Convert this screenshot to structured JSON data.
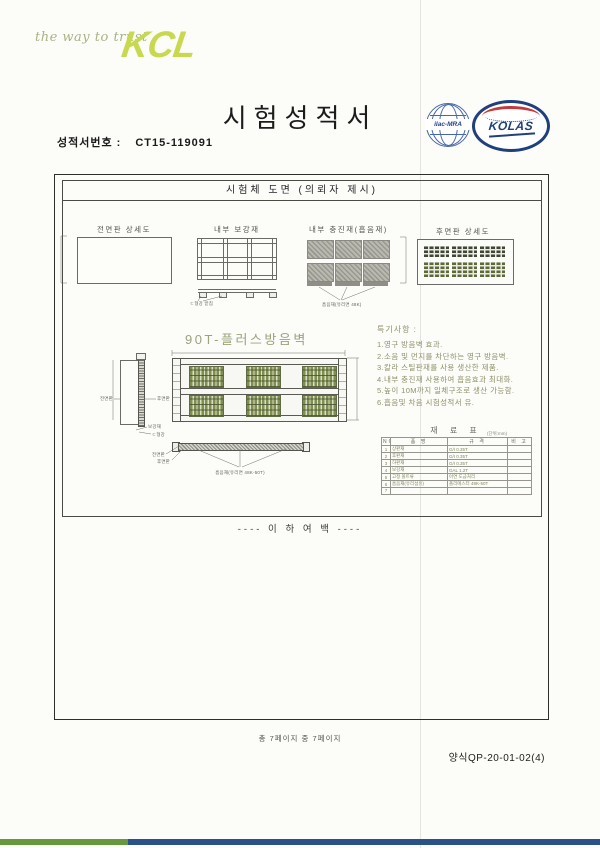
{
  "header": {
    "tagline": "the way to trust",
    "brand": "KCL",
    "title": "시험성적서",
    "report_no_label": "성적서번호 :",
    "report_no": "CT15-119091",
    "cert_ilac": "ilac-MRA",
    "cert_kolas": "KOLAS"
  },
  "drawing": {
    "box_title": "시험체 도면 (의뢰자 제시)",
    "view_labels": {
      "front": "전면판 상세도",
      "reinforce": "내부 보강재",
      "filler": "내부 충진재(흡음재)",
      "rear": "후면판 상세도"
    },
    "product_label": "90T-플러스방음벽",
    "callouts": {
      "reinforce_note": "ㄷ형강 받침",
      "filler_note": "흡음재(유리면 48K)",
      "side_front": "전면판",
      "side_rear": "후면판",
      "side_b1": "보강재",
      "side_b2": "ㄷ형강",
      "sec_l1": "전면판",
      "sec_l2": "후면판",
      "sec_note": "흡음재(유리면 48K-50T)"
    },
    "notes_title": "특기사항 :",
    "notes": [
      "1.영구 방음벽 효과.",
      "2.소음 및 먼지를 차단하는 영구 방음벽.",
      "3.칼라 스틸판재를 사용 생산한 제품.",
      "4.내부 충진재 사용하여 흡음효과 최대화.",
      "5.높이 10M까지 일체구조로 생산 가능함.",
      "6.흡음및 차음 시험성적서 유."
    ],
    "table": {
      "title": "재 료 표",
      "unit_note": "(단위:mm)",
      "headers": [
        "NO",
        "품 명",
        "규 격",
        "비 고"
      ],
      "rows": [
        [
          "1",
          "상판재",
          "G/I 0.35T",
          ""
        ],
        [
          "2",
          "후판재",
          "G/I 0.35T",
          ""
        ],
        [
          "3",
          "하판재",
          "G/I 0.35T",
          ""
        ],
        [
          "4",
          "보강재",
          "GAL 1.2T",
          ""
        ],
        [
          "5",
          "고정 볼트류",
          "아연 도금처리",
          ""
        ],
        [
          "6",
          "흡음재(유리섬유)",
          "폴리에스터 48K-50T",
          ""
        ],
        [
          "7",
          "",
          "",
          ""
        ]
      ]
    },
    "blank_note": "---- 이  하  여  백 ----"
  },
  "footer": {
    "page_info": "총 7페이지 중 7페이지",
    "form_no": "양식QP-20-01-02(4)"
  },
  "colors": {
    "brand_green": "#c9d94f",
    "bar_green": "#67983e",
    "bar_navy": "#2a5188",
    "panel_green": "#7f8e51",
    "kolas_navy": "#20407c",
    "kolas_red": "#c23a3a"
  }
}
